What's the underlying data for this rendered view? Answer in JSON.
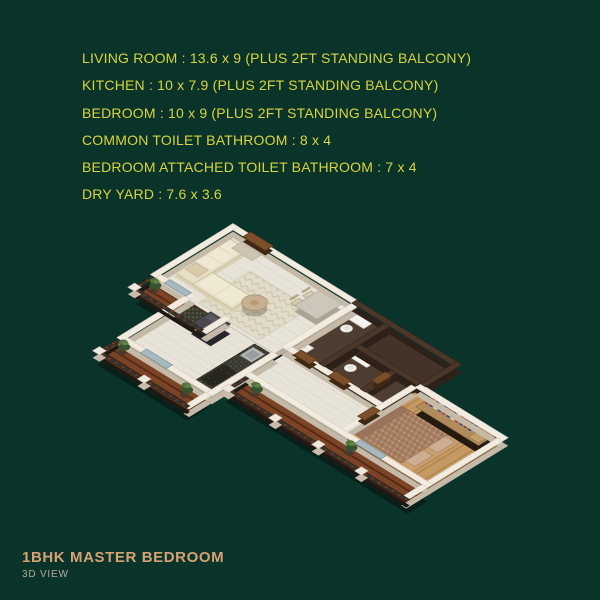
{
  "palette": {
    "background": "#0a3329",
    "info_text": "#d8d43f",
    "footer_title": "#d7a273",
    "footer_subtitle": "#b3aa9c",
    "wall_white": "#f2ebe0",
    "wall_dark_brown": "#4a372a",
    "marble_floor": "#e8e3d9",
    "bedroom_wood_floor": "#c59a62",
    "balcony_deck_wood": "#7b4426",
    "toilet_floor": "#4e3d31",
    "railing_dark": "#332e29",
    "sofa_cream": "#e7dec6",
    "bed_brown": "#a87f63",
    "plant_green": "#44663a"
  },
  "info_panel": {
    "lines": [
      "LIVING ROOM : 13.6 x 9 (PLUS 2FT STANDING BALCONY)",
      "KITCHEN : 10 x 7.9 (PLUS 2FT STANDING BALCONY)",
      "BEDROOM : 10 x 9 (PLUS 2FT STANDING BALCONY)",
      "COMMON TOILET BATHROOM : 8 x 4",
      "BEDROOM ATTACHED TOILET BATHROOM : 7 x 4",
      "DRY YARD : 7.6 x 3.6"
    ]
  },
  "footer": {
    "title": "1BHK MASTER BEDROOM",
    "subtitle": "3D VIEW"
  },
  "floorplan": {
    "view": "3d-isometric",
    "rooms": [
      "living-room",
      "kitchen",
      "bedroom",
      "common-toilet-bathroom",
      "bedroom-attached-toilet-bathroom",
      "dry-yard",
      "living-balcony",
      "kitchen-balcony",
      "bedroom-balcony"
    ]
  }
}
